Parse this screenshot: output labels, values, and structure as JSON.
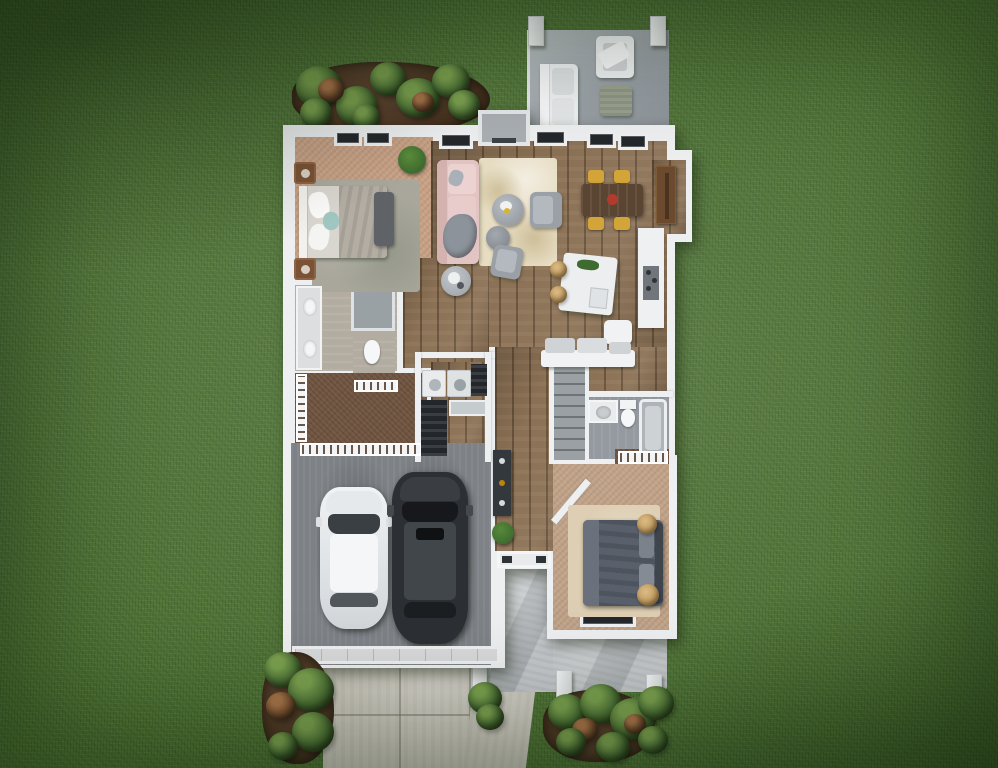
{
  "scene": {
    "title": "aerial-3d-floor-plan-render",
    "description": "Top-down 3D dollhouse rendering of a single-story home on a green grass lot with rear patio, two-car garage, driveway and landscaping",
    "palette": {
      "grass": "#4d7134",
      "bushGreen": "#53783a",
      "bushLight": "#7ba04f",
      "bushDark": "#2e4a1e",
      "mulchBrown": "#4a3523",
      "wall": "#edeff0",
      "woodFloor": "#8a7054",
      "carpetTan": "#c7a084",
      "carpetTan2": "#c0a287",
      "carpetBrown": "#6d523e",
      "bathTile": "#b3aca1",
      "bathTile2": "#949aa0",
      "garageFloor": "#7e8287",
      "patioConcrete": "#9aa1a7",
      "porch": "#c5c8cb",
      "driveway": "#cac6bc",
      "islandWhite": "#eceef0",
      "sofaPink": "#e2c4c2",
      "rugCream": "#e7ddc3",
      "rugSage": "#a9a79b",
      "furnitureGray": "#9aa0a6",
      "bedLinenMaster": "#b3ada3",
      "bedDark": "#59606b",
      "chairYellow": "#d3a437",
      "tableWood": "#5a4533",
      "accentRed": "#b23b2e",
      "stoolTan": "#bd8a55",
      "carWhite": "#e9ecee",
      "carBlack": "#2c2f33",
      "stairGray": "#85898d",
      "windowDark": "#24282c",
      "plantGreen": "#3e6b2f"
    },
    "rooms": [
      {
        "name": "rear-patio",
        "floor": "concrete"
      },
      {
        "name": "master-bedroom",
        "floor": "tan-carpet"
      },
      {
        "name": "master-bathroom",
        "floor": "tile"
      },
      {
        "name": "shower",
        "floor": "tile"
      },
      {
        "name": "water-closet",
        "floor": "tile"
      },
      {
        "name": "walk-in-closet",
        "floor": "brown-carpet"
      },
      {
        "name": "great-room",
        "floor": "hardwood"
      },
      {
        "name": "dining-area",
        "floor": "hardwood"
      },
      {
        "name": "kitchen",
        "floor": "hardwood"
      },
      {
        "name": "laundry-mudroom",
        "floor": "hardwood"
      },
      {
        "name": "hallway",
        "floor": "hardwood"
      },
      {
        "name": "entry-foyer",
        "floor": "hardwood"
      },
      {
        "name": "stairwell",
        "floor": "gray-steps"
      },
      {
        "name": "hall-bathroom",
        "floor": "tile"
      },
      {
        "name": "hall-closet",
        "floor": "brown-carpet"
      },
      {
        "name": "bedroom-2",
        "floor": "tan-carpet"
      },
      {
        "name": "two-car-garage",
        "floor": "concrete"
      }
    ],
    "furniture": [
      "patio-sofa",
      "patio-armchair",
      "patio-ottoman",
      "master-bed",
      "nightstand-upper",
      "nightstand-lower",
      "foot-bench",
      "master-rug",
      "potted-plant",
      "pink-sectional-sofa",
      "living-rug",
      "coffee-table-large",
      "coffee-table-small",
      "gray-armchair",
      "gray-side-chair",
      "round-side-table",
      "dining-table",
      "dining-chair-1",
      "dining-chair-2",
      "dining-chair-3",
      "dining-chair-4",
      "red-centerpiece",
      "kitchen-island",
      "island-sink",
      "bar-stool-1",
      "bar-stool-2",
      "wall-counter",
      "cooktop",
      "buffet-sideboard",
      "family-sofa-white",
      "washer",
      "dryer",
      "pantry-shelf-upper",
      "pantry-shelf-lower",
      "utility-sink",
      "double-vanity",
      "shower-glass",
      "toilet-master",
      "closet-rod-racks",
      "vanity-2",
      "toilet-2",
      "bathtub",
      "hanger-rod",
      "bed-2",
      "bedroom2-rug",
      "pouf-upper",
      "pouf-lower",
      "entry-console",
      "entry-plant",
      "front-door",
      "fireplace-chimney"
    ],
    "vehicles": [
      "white-sedan",
      "dark-gray-suv"
    ],
    "exterior": [
      "rear-patio-slab",
      "patio-pillars",
      "front-porch-slab",
      "porch-pillars",
      "driveway-slab",
      "front-walkway",
      "mulch-bed-rear",
      "shrub-cluster-rear",
      "shrub-cluster-garage-side",
      "shrub-cluster-front",
      "garage-door"
    ]
  }
}
